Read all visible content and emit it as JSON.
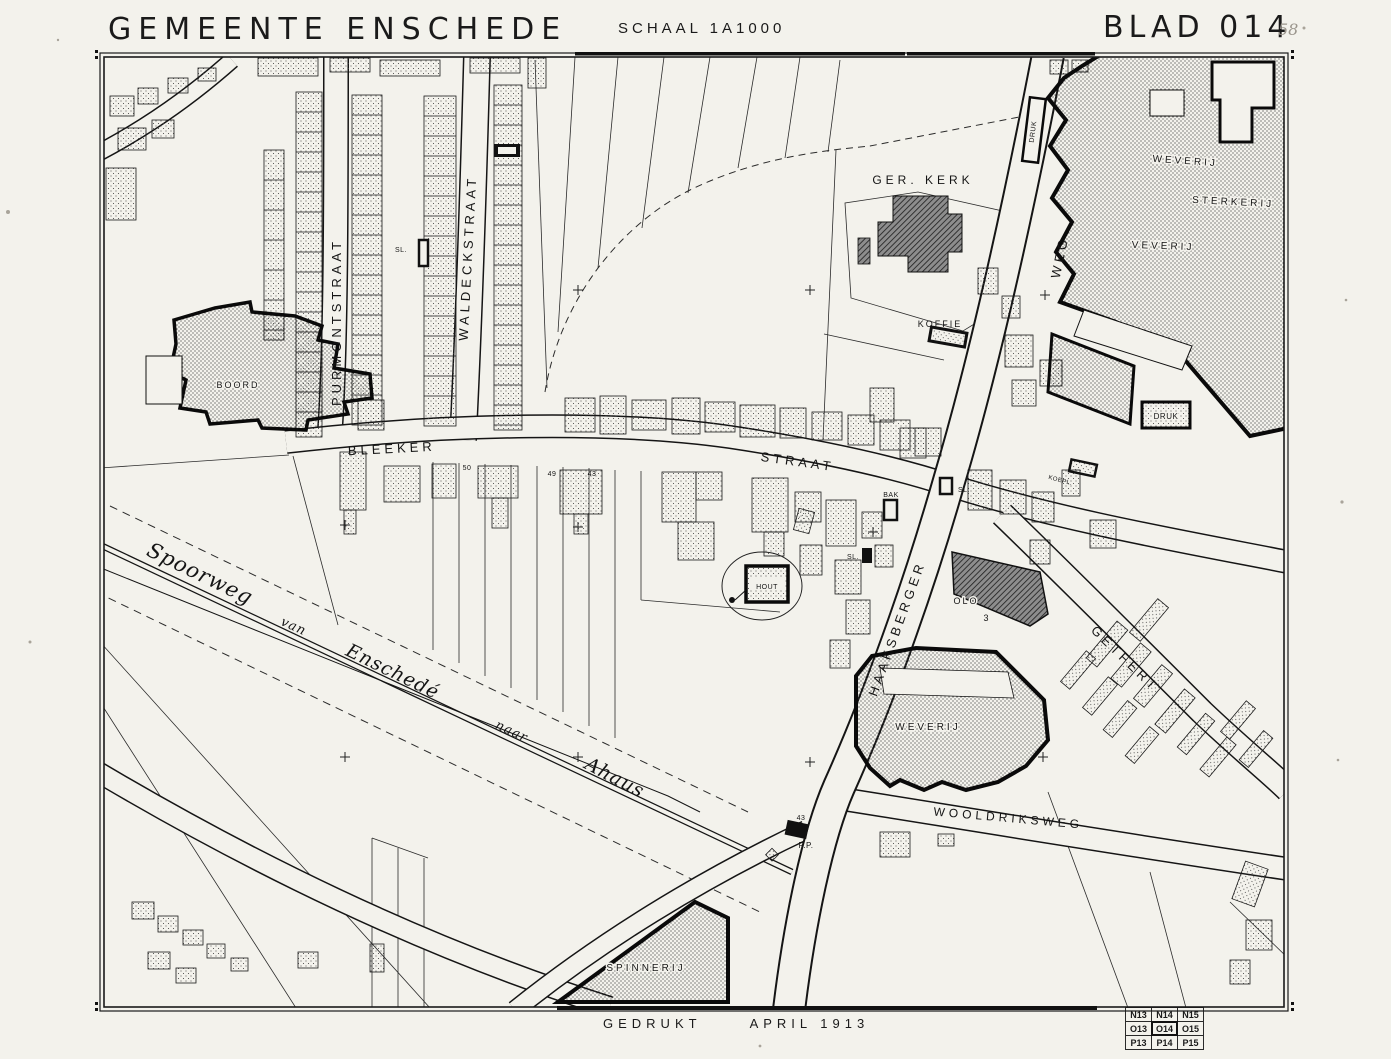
{
  "page": {
    "title": "GEMEENTE ENSCHEDE",
    "scale": "SCHAAL 1A1000",
    "sheet": "BLAD 014",
    "sheet_note": "58",
    "printed_label": "GEDRUKT",
    "printed_date": "APRIL 1913"
  },
  "index_grid": {
    "rows": [
      [
        "N13",
        "N14",
        "N15"
      ],
      [
        "O13",
        "O14",
        "O15"
      ],
      [
        "P13",
        "P14",
        "P15"
      ]
    ],
    "current": "O14"
  },
  "streets": {
    "bleeker": "BLEEKER",
    "straat": "STRAAT",
    "purmontstraat": "PURMONTSTRAAT",
    "waldeckstraat": "WALDECKSTRAAT",
    "haaksberger": "HAAKSBERGER",
    "weg": "WEG",
    "getfert": "GETFERT",
    "wooldriksweg": "WOOLDRIKSWEG"
  },
  "buildings": {
    "ger_kerk": "GER. KERK",
    "koffie": "KOFFIE",
    "weverij_north": "WEVERIJ",
    "sterkerij": "STERKERIJ",
    "veverij": "VEVERIJ",
    "druk_north": "DRUK",
    "druk_east": "DRUK",
    "boord": "BOORD",
    "weverij_south": "WEVERIJ",
    "spinnerij": "SPINNERIJ",
    "hout": "HOUT",
    "olo": "OLO",
    "olo_number": "3",
    "bak": "BAK",
    "sl_1": "SL.",
    "sl_2": "SL.",
    "sl_3": "SL.",
    "koepl": "KOEPL.",
    "pp": "P.P."
  },
  "numbers": {
    "n50": "50",
    "n49": "49",
    "n43_bleeker": "43",
    "n43_pp": "43"
  },
  "railway": {
    "w1": "Spoorweg",
    "w2": "van",
    "w3": "Enschedé",
    "w4": "naar",
    "w5": "Ahaus"
  },
  "colors": {
    "paper": "#f3f2ec",
    "ink": "#1a1a1a"
  }
}
